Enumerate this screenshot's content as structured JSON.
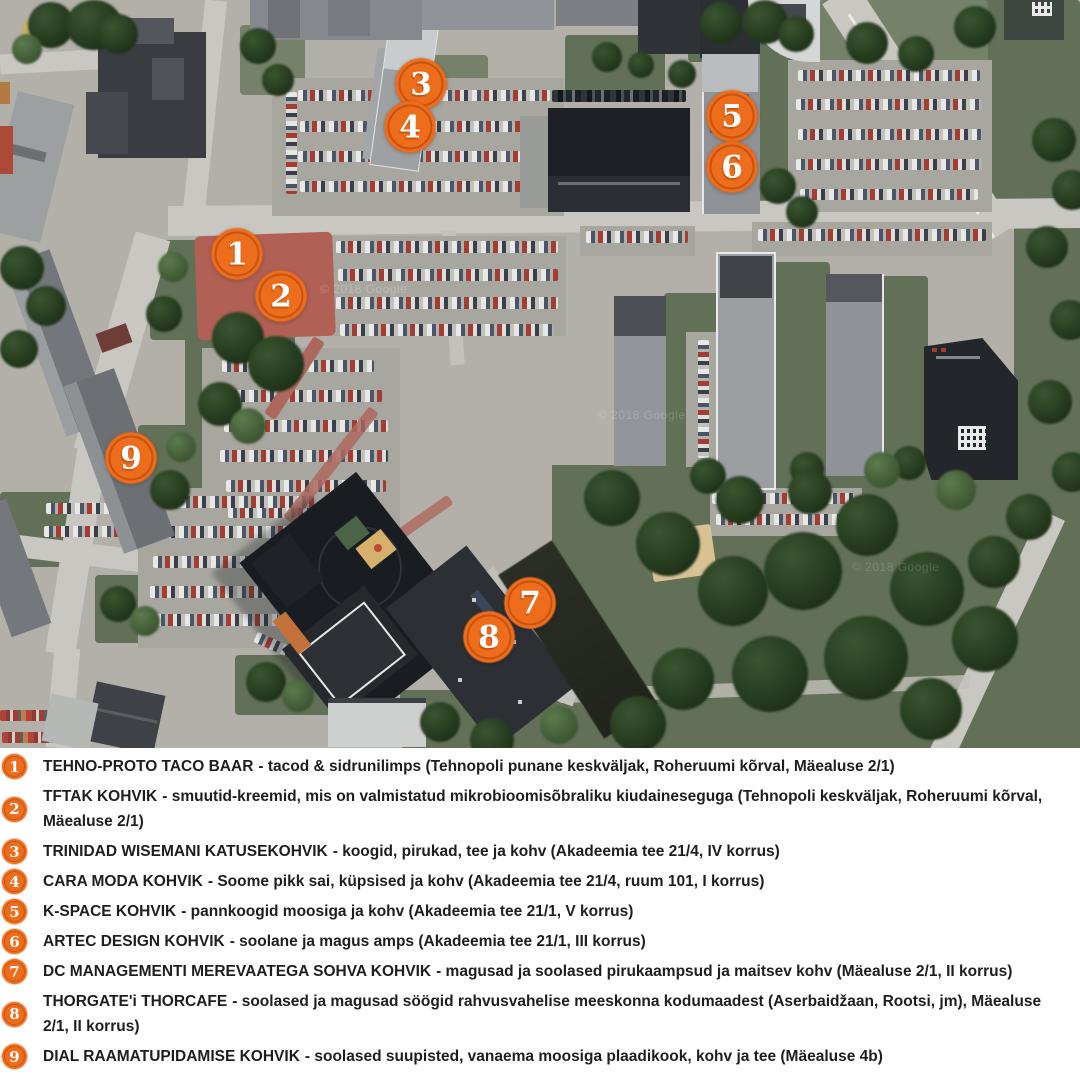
{
  "map": {
    "watermark": "© 2018 Google",
    "marker_color": "#EE6D1C",
    "markers": [
      {
        "label": "1"
      },
      {
        "label": "2"
      },
      {
        "label": "3"
      },
      {
        "label": "4"
      },
      {
        "label": "5"
      },
      {
        "label": "6"
      },
      {
        "label": "7"
      },
      {
        "label": "8"
      },
      {
        "label": "9"
      }
    ]
  },
  "legend": {
    "items": [
      {
        "num": "1",
        "name": "TEHNO-PROTO TACO BAAR",
        "desc": "- tacod & sidrunilimps (Tehnopoli punane keskväljak, Roheruumi kõrval, Mäealuse 2/1)"
      },
      {
        "num": "2",
        "name": "TFTAK KOHVIK",
        "desc": "- smuutid-kreemid, mis on valmistatud mikrobioomisõbraliku kiudaineseguga (Tehnopoli keskväljak, Roheruumi kõrval, Mäealuse 2/1)"
      },
      {
        "num": "3",
        "name": "TRINIDAD WISEMANI KATUSEKOHVIK",
        "desc": "- koogid, pirukad, tee ja kohv (Akadeemia tee 21/4, IV korrus)"
      },
      {
        "num": "4",
        "name": "CARA MODA KOHVIK",
        "desc": "- Soome pikk sai, küpsised ja kohv (Akadeemia tee 21/4, ruum 101, I korrus)"
      },
      {
        "num": "5",
        "name": "K-SPACE KOHVIK",
        "desc": "- pannkoogid moosiga ja kohv (Akadeemia tee 21/1, V korrus)"
      },
      {
        "num": "6",
        "name": "ARTEC DESIGN KOHVIK",
        "desc": "- soolane ja magus amps (Akadeemia tee 21/1, III korrus)"
      },
      {
        "num": "7",
        "name": "DC MANAGEMENTI MEREVAATEGA SOHVA KOHVIK",
        "desc": "- magusad ja soolased pirukaampsud ja maitsev kohv (Mäealuse 2/1, II korrus)"
      },
      {
        "num": "8",
        "name": "THORGATE'i THORCAFE",
        "desc": "- soolased ja magusad söögid rahvusvahelise meeskonna kodumaadest (Aserbaidžaan, Rootsi, jm), Mäealuse 2/1, II korrus)"
      },
      {
        "num": "9",
        "name": "DIAL RAAMATUPIDAMISE KOHVIK",
        "desc": "- soolased suupisted, vanaema moosiga plaadikook, kohv ja tee (Mäealuse 4b)"
      }
    ]
  }
}
